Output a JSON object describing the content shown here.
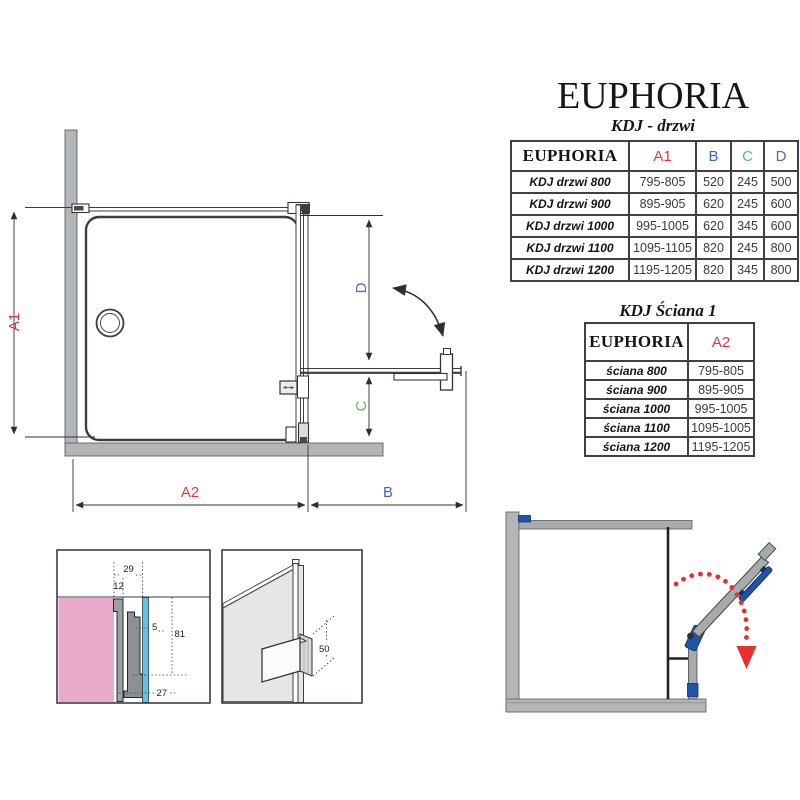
{
  "header": {
    "title": "EUPHORIA",
    "subtitle": "KDJ - drzwi"
  },
  "door_table": {
    "col_name": "EUPHORIA",
    "col_a1": "A1",
    "col_b": "B",
    "col_c": "C",
    "col_d": "D",
    "rows": [
      {
        "label": "KDJ drzwi 800",
        "a1": "795-805",
        "b": "520",
        "c": "245",
        "d": "500"
      },
      {
        "label": "KDJ drzwi 900",
        "a1": "895-905",
        "b": "620",
        "c": "245",
        "d": "600"
      },
      {
        "label": "KDJ drzwi 1000",
        "a1": "995-1005",
        "b": "620",
        "c": "345",
        "d": "600"
      },
      {
        "label": "KDJ drzwi 1100",
        "a1": "1095-1105",
        "b": "820",
        "c": "245",
        "d": "800"
      },
      {
        "label": "KDJ drzwi 1200",
        "a1": "1195-1205",
        "b": "820",
        "c": "345",
        "d": "800"
      }
    ]
  },
  "wall_table": {
    "title": "KDJ Ściana 1",
    "col_name": "EUPHORIA",
    "col_a2": "A2",
    "rows": [
      {
        "label": "ściana 800",
        "a2": "795-805"
      },
      {
        "label": "ściana 900",
        "a2": "895-905"
      },
      {
        "label": "ściana 1000",
        "a2": "995-1005"
      },
      {
        "label": "ściana 1100",
        "a2": "1095-1005"
      },
      {
        "label": "ściana 1200",
        "a2": "1195-1205"
      }
    ]
  },
  "plan": {
    "dim_a1": "A1",
    "dim_a2": "A2",
    "dim_b": "B",
    "dim_c": "C",
    "dim_d": "D"
  },
  "detail_profile": {
    "dim_29": "29",
    "dim_12": "12",
    "dim_5": "5",
    "dim_81": "81",
    "dim_27": "27"
  },
  "detail_handle": {
    "dim_50": "50"
  },
  "colors": {
    "dim_red": "#e3353b",
    "dim_blue": "#4061c8",
    "dim_green": "#57c05c",
    "dim_violet": "#6e5cc3",
    "hinge_blue": "#2353a8",
    "swing_red": "#e8302e",
    "wall_gray": "#b3b6b8",
    "glass_cyan": "#5fc4e4",
    "wall_pink": "#eaaacb"
  }
}
